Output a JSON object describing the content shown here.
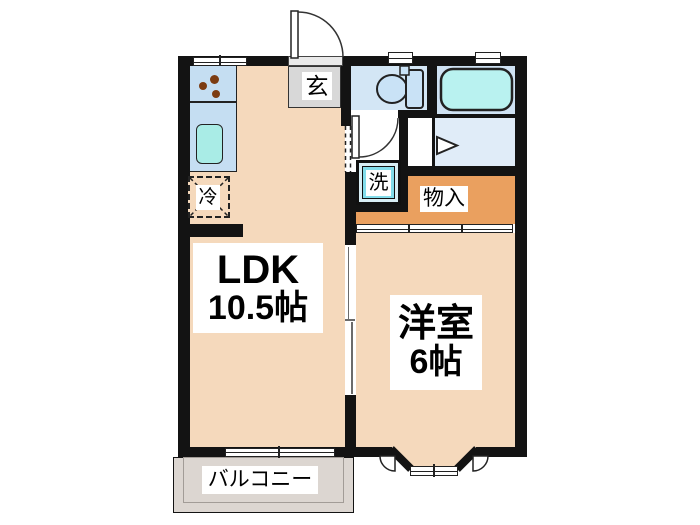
{
  "drawing": {
    "type": "apartment-floor-plan",
    "layout": "1LDK"
  },
  "rooms": {
    "ldk": {
      "label": "LDK",
      "size": "10.5帖"
    },
    "western": {
      "label": "洋室",
      "size": "6帖"
    },
    "balcony": {
      "label": "バルコニー"
    },
    "entrance": {
      "label": "玄"
    },
    "storage": {
      "label": "物入"
    }
  },
  "fixtures": {
    "washer": {
      "label": "洗",
      "icon": "washing-machine-icon"
    },
    "refrigerator": {
      "label": "冷",
      "icon": "refrigerator-icon"
    },
    "toilet": {
      "icon": "toilet-icon"
    },
    "bathtub": {
      "icon": "bathtub-icon"
    },
    "stove": {
      "icon": "stove-burners-icon"
    },
    "kitchen_sink": {
      "icon": "kitchen-sink-icon"
    },
    "entrance_door": {
      "icon": "door-swing-icon"
    },
    "toilet_door": {
      "icon": "door-swing-icon"
    },
    "bath_door": {
      "icon": "door-direction-triangle-icon"
    },
    "bay_window": {
      "icon": "bay-window-icon"
    }
  },
  "colors": {
    "wall": "#131313",
    "floor_peach": "#f5d9bc",
    "storage_orange": "#eaa05f",
    "balcony_gray": "#dcd6d1",
    "entrance_gray": "#d8d8d8",
    "wet_area_blue": "#d3e6f5",
    "bath_floor_blue": "#e0ecf8",
    "bathtub_cyan": "#b9f2f0",
    "counter_blue": "#c5def2",
    "sink_cyan": "#a9ece6",
    "washer_cyan": "#82dcea",
    "burner_brown": "#7c3c12"
  }
}
